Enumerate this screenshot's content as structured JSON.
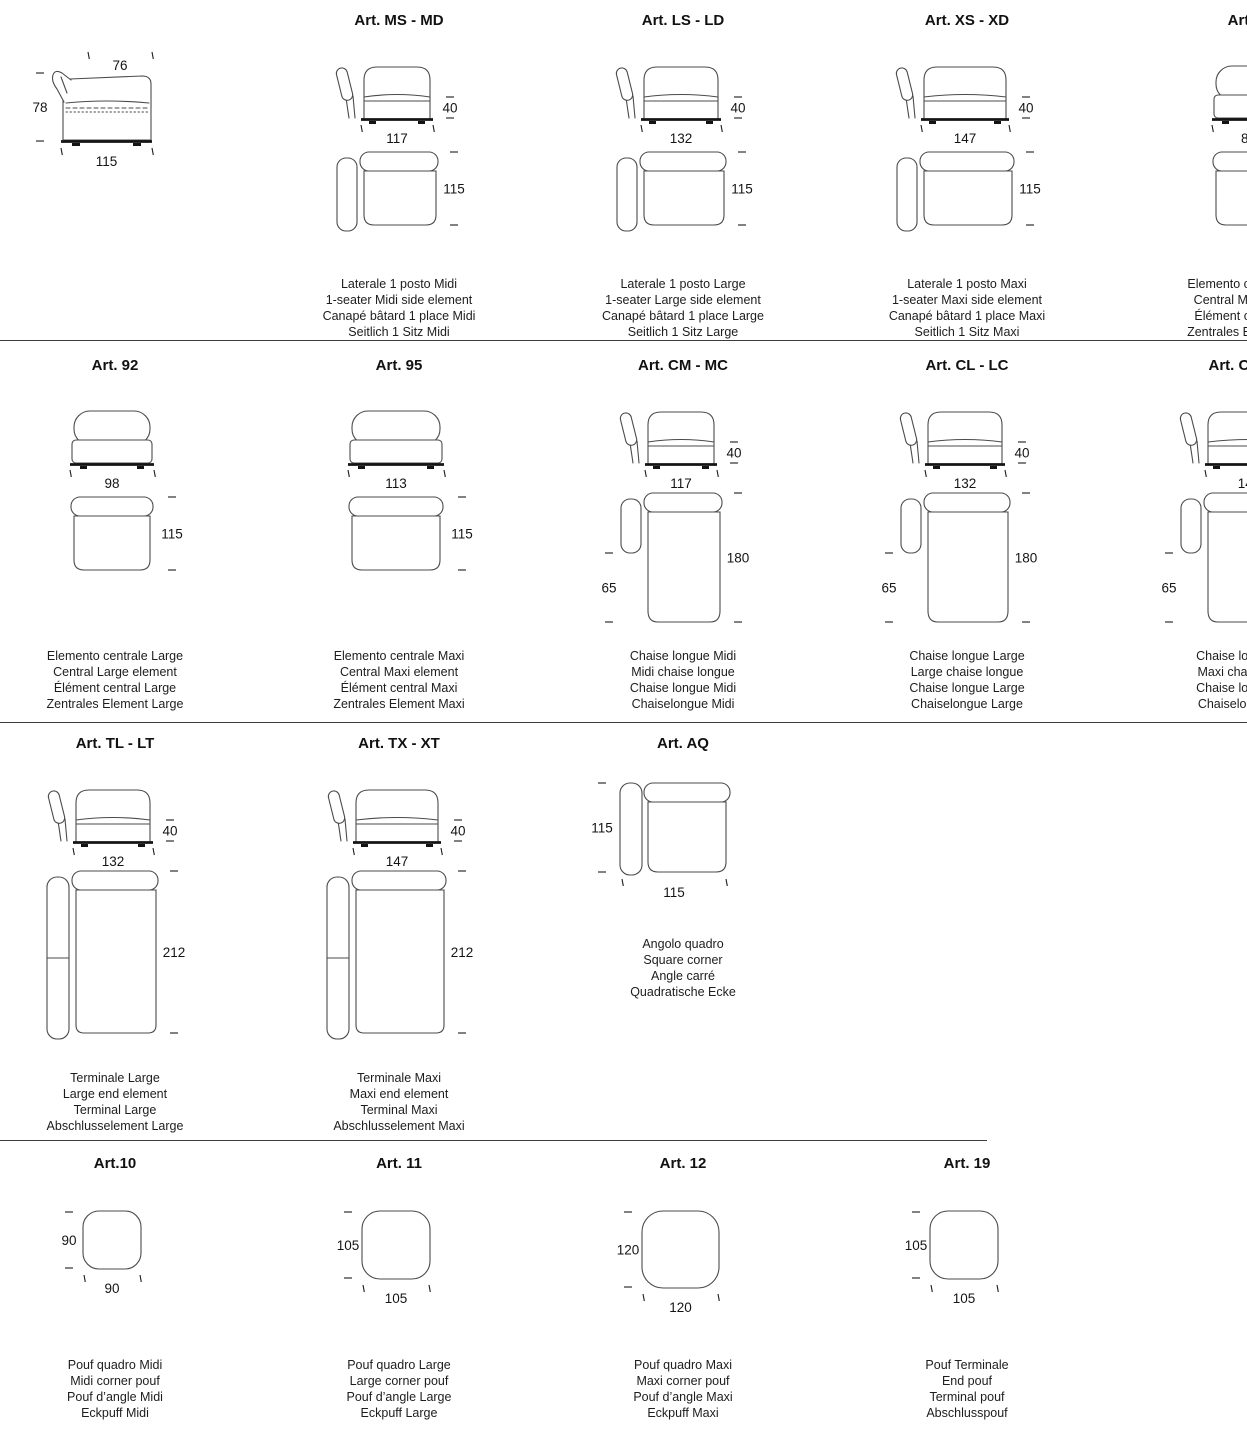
{
  "page": {
    "background": "#ffffff",
    "line_color": "#4b4b4b",
    "text_color": "#1a1a1a",
    "divider_color": "#3c3c3c"
  },
  "rows": [
    {
      "divider_after": "full",
      "cells": [
        {
          "title": "",
          "views": [
            {
              "kind": "side",
              "top": "76",
              "left": "78",
              "bottom": "115"
            }
          ],
          "captions": []
        },
        {
          "title": "Art. MS - MD",
          "views": [
            {
              "kind": "front-arm",
              "width": "117",
              "height": "40"
            },
            {
              "kind": "top-arm",
              "depth": "115"
            }
          ],
          "captions": [
            "Laterale 1 posto Midi",
            "1-seater Midi side element",
            "Canapé bâtard 1 place Midi",
            "Seitlich 1 Sitz Midi"
          ]
        },
        {
          "title": "Art. LS - LD",
          "views": [
            {
              "kind": "front-arm",
              "width": "132",
              "height": "40"
            },
            {
              "kind": "top-arm",
              "depth": "115"
            }
          ],
          "captions": [
            "Laterale 1 posto Large",
            "1-seater Large side element",
            "Canapé bâtard 1 place Large",
            "Seitlich 1 Sitz Large"
          ]
        },
        {
          "title": "Art. XS - XD",
          "views": [
            {
              "kind": "front-arm",
              "width": "147",
              "height": "40"
            },
            {
              "kind": "top-arm",
              "depth": "115"
            }
          ],
          "captions": [
            "Laterale 1 posto Maxi",
            "1-seater Maxi side element",
            "Canapé bâtard 1 place Maxi",
            "Seitlich 1 Sitz Maxi"
          ]
        },
        {
          "title": "Art. 91",
          "views": [
            {
              "kind": "front-plain",
              "width": "83",
              "height": "78"
            },
            {
              "kind": "top-plain",
              "depth": "115"
            }
          ],
          "captions": [
            "Elemento centrale Midi",
            "Central Midi element",
            "Élément central Midi",
            "Zentrales Element Midi"
          ]
        }
      ]
    },
    {
      "divider_after": "full",
      "cells": [
        {
          "title": "Art. 92",
          "views": [
            {
              "kind": "front-plain",
              "width": "98"
            },
            {
              "kind": "top-plain",
              "depth": "115"
            }
          ],
          "captions": [
            "Elemento centrale Large",
            "Central Large element",
            "Élément central Large",
            "Zentrales Element Large"
          ]
        },
        {
          "title": "Art. 95",
          "views": [
            {
              "kind": "front-plain",
              "width": "113"
            },
            {
              "kind": "top-plain",
              "depth": "115"
            }
          ],
          "captions": [
            "Elemento centrale Maxi",
            "Central Maxi element",
            "Élément central Maxi",
            "Zentrales Element Maxi"
          ]
        },
        {
          "title": "Art. CM - MC",
          "views": [
            {
              "kind": "front-arm",
              "width": "117",
              "height": "40"
            },
            {
              "kind": "top-chaise",
              "depth": "180",
              "arm": "65"
            }
          ],
          "captions": [
            "Chaise longue Midi",
            "Midi chaise longue",
            "Chaise longue Midi",
            "Chaiselongue Midi"
          ]
        },
        {
          "title": "Art. CL - LC",
          "views": [
            {
              "kind": "front-arm",
              "width": "132",
              "height": "40"
            },
            {
              "kind": "top-chaise",
              "depth": "180",
              "arm": "65"
            }
          ],
          "captions": [
            "Chaise longue Large",
            "Large chaise longue",
            "Chaise longue Large",
            "Chaiselongue Large"
          ]
        },
        {
          "title": "Art. CX - XC",
          "views": [
            {
              "kind": "front-arm",
              "width": "147",
              "height": "40"
            },
            {
              "kind": "top-chaise",
              "depth": "180",
              "arm": "65"
            }
          ],
          "captions": [
            "Chaise longue Maxi",
            "Maxi chaise longue",
            "Chaise longue Maxi",
            "Chaiselongue Maxi"
          ]
        }
      ]
    },
    {
      "divider_after": "partial",
      "cells": [
        {
          "title": "Art. TL - LT",
          "views": [
            {
              "kind": "front-arm",
              "width": "132",
              "height": "40"
            },
            {
              "kind": "top-terminal",
              "depth": "212"
            }
          ],
          "captions": [
            "Terminale Large",
            "Large end element",
            "Terminal Large",
            "Abschlusselement Large"
          ]
        },
        {
          "title": "Art. TX - XT",
          "views": [
            {
              "kind": "front-arm",
              "width": "147",
              "height": "40"
            },
            {
              "kind": "top-terminal",
              "depth": "212"
            }
          ],
          "captions": [
            "Terminale Maxi",
            "Maxi end element",
            "Terminal Maxi",
            "Abschlusselement Maxi"
          ]
        },
        {
          "title": "Art. AQ",
          "views": [
            {
              "kind": "top-corner",
              "left": "115",
              "bottom": "115"
            }
          ],
          "captions": [
            "Angolo quadro",
            "Square corner",
            "Angle carré",
            "Quadratische Ecke"
          ]
        }
      ]
    },
    {
      "divider_after": "none",
      "cells": [
        {
          "title": "Art.10",
          "views": [
            {
              "kind": "pouf",
              "left": "90",
              "bottom": "90"
            }
          ],
          "captions": [
            "Pouf quadro Midi",
            "Midi corner pouf",
            "Pouf d’angle Midi",
            "Eckpuff Midi"
          ]
        },
        {
          "title": "Art. 11",
          "views": [
            {
              "kind": "pouf",
              "left": "105",
              "bottom": "105"
            }
          ],
          "captions": [
            "Pouf quadro Large",
            "Large corner pouf",
            "Pouf d’angle Large",
            "Eckpuff Large"
          ]
        },
        {
          "title": "Art. 12",
          "views": [
            {
              "kind": "pouf",
              "left": "120",
              "bottom": "120"
            }
          ],
          "captions": [
            "Pouf quadro Maxi",
            "Maxi corner pouf",
            "Pouf d’angle Maxi",
            "Eckpuff Maxi"
          ]
        },
        {
          "title": "Art. 19",
          "views": [
            {
              "kind": "pouf",
              "left": "105",
              "bottom": "105"
            }
          ],
          "captions": [
            "Pouf Terminale",
            "End pouf",
            "Terminal pouf",
            "Abschlusspouf"
          ]
        }
      ]
    }
  ]
}
